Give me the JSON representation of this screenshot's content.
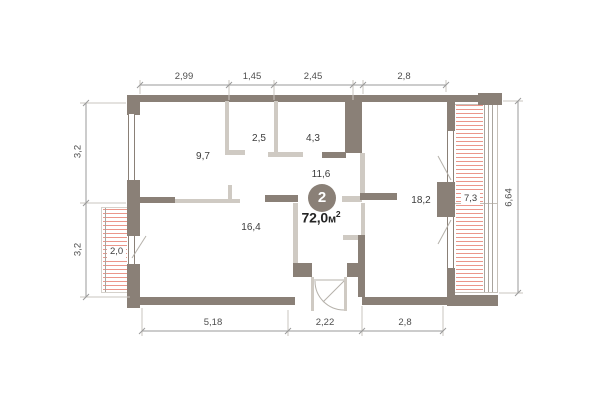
{
  "plan": {
    "badge": {
      "number": "2"
    },
    "total_area": {
      "value": "72,0",
      "unit": "м",
      "power": "2"
    },
    "rooms": [
      {
        "name": "room-9-7",
        "area": "9,7"
      },
      {
        "name": "room-2-5",
        "area": "2,5"
      },
      {
        "name": "room-4-3",
        "area": "4,3"
      },
      {
        "name": "hall-11-6",
        "area": "11,6"
      },
      {
        "name": "room-18-2",
        "area": "18,2"
      },
      {
        "name": "room-16-4",
        "area": "16,4"
      },
      {
        "name": "balcony-2-0",
        "area": "2,0"
      },
      {
        "name": "balcony-7-3",
        "area": "7,3"
      }
    ],
    "dimensions": {
      "top": [
        "2,99",
        "1,45",
        "2,45",
        "2,8"
      ],
      "bottom": [
        "5,18",
        "2,22",
        "2,8"
      ],
      "left": [
        "3,2",
        "3,2"
      ],
      "right": [
        "6,64"
      ]
    },
    "colors": {
      "wall": "#8a8077",
      "wall_light": "#cfcac3",
      "hatch": "#eb968a",
      "dim_line": "#9a9a9a",
      "ext_line": "#c9c5bf",
      "swing_line": "#b5b1aa",
      "text": "#3c3c3c",
      "badge_bg": "#8a8077",
      "badge_text": "#ffffff"
    }
  }
}
